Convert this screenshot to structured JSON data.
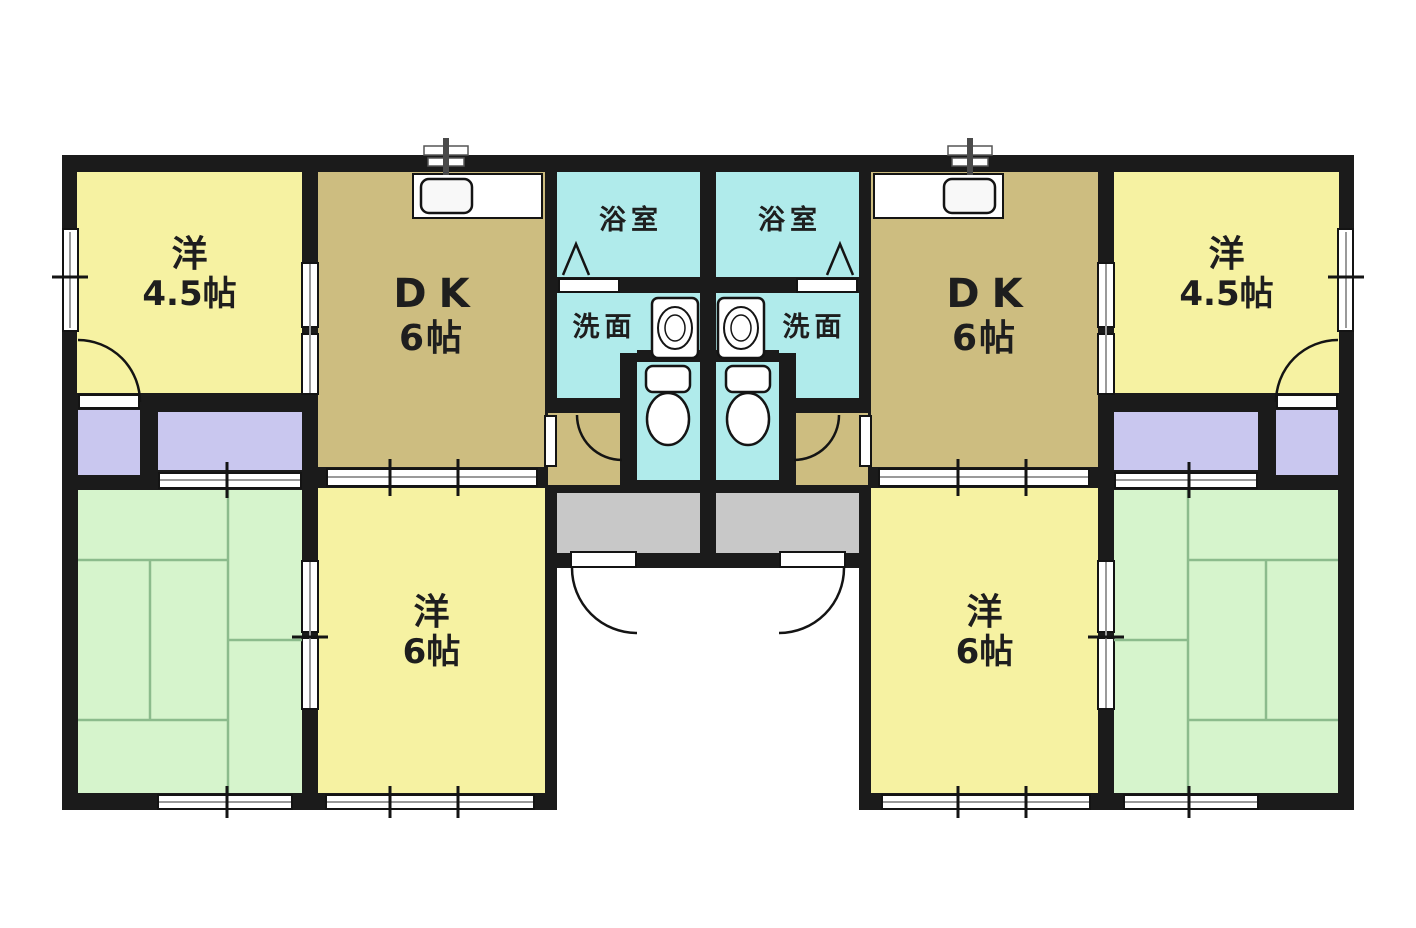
{
  "plan": {
    "kind": "Japanese apartment floor plan — mirrored duplex with two identical units",
    "palette": {
      "wall": "#1b1b1b",
      "western_room": "#f6f2a2",
      "dining_kitchen": "#cdbd80",
      "wet_area": "#b0ebeb",
      "closet": "#c9c7ef",
      "tatami": "#d6f4cc",
      "tatami_line": "#8cbb8c",
      "entrance": "#c8c8c8",
      "background": "#ffffff"
    },
    "units": [
      {
        "side": "left",
        "rooms": {
          "western_45": {
            "label": "洋",
            "area": "4.5帖"
          },
          "dk": {
            "label": "DK",
            "area": "6帖"
          },
          "bath": {
            "label": "浴室"
          },
          "wash": {
            "label": "洗面"
          },
          "western_6": {
            "label": "洋",
            "area": "6帖"
          }
        }
      },
      {
        "side": "right",
        "rooms": {
          "western_45": {
            "label": "洋",
            "area": "4.5帖"
          },
          "dk": {
            "label": "DK",
            "area": "6帖"
          },
          "bath": {
            "label": "浴室"
          },
          "wash": {
            "label": "洗面"
          },
          "western_6": {
            "label": "洋",
            "area": "6帖"
          }
        }
      }
    ]
  }
}
